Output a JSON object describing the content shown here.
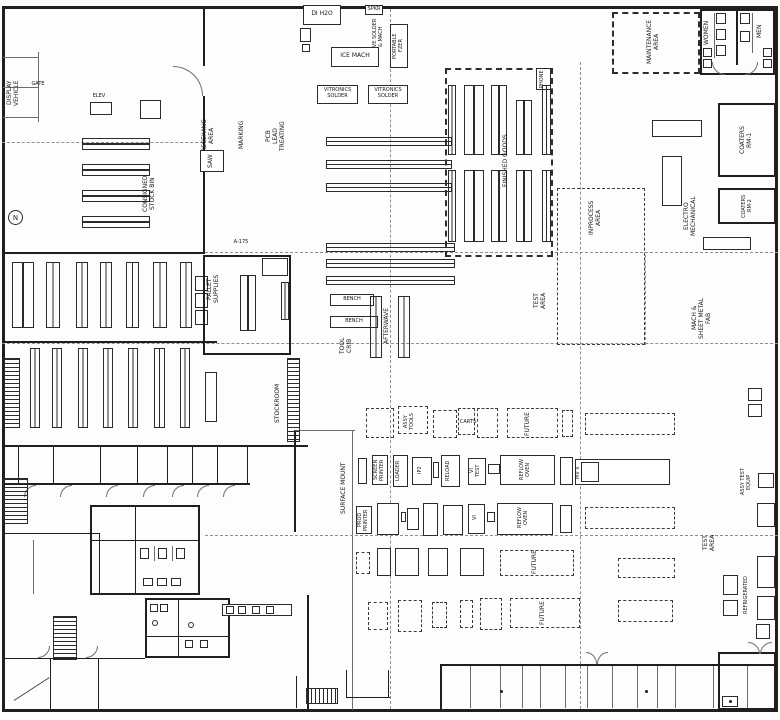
{
  "colors": {
    "paper": "#fdfdfb",
    "ink": "#1f1f1f",
    "grid_gray": "#8f8f8f"
  },
  "labels": {
    "display_vehicle": "DISPLAY\nVEHICLE",
    "gate": "GATE",
    "elev": "ELEV",
    "north_marker": "N",
    "consigned_stock": "CONSIGNED\nSTOCK BIN",
    "receiving_area": "RECEIVING\nAREA",
    "marking": "MARKING",
    "pcb_lead_treating": "PCB\nLEAD\nTREATING",
    "saw": "SAW",
    "a175": "A-175",
    "di_h2o": "DI H2O",
    "spkr": "SPKR",
    "wave_solder": "WAVE SOLDER\n& MACH",
    "portable_fzer": "PORTABLE\nFZER",
    "ice_mach": "ICE MACH",
    "vitronics_1": "VITRONICS\nSOLDER",
    "vitronics_2": "VITRONICS\nSOLDER",
    "bench_1": "BENCH",
    "bench_2": "BENCH",
    "afterwave": "AFTERWAVE",
    "tool_crib": "TOOL\nCRIB",
    "finished_goods": "FINISHED GOODS",
    "phone": "PHONE",
    "inprocess_area": "INPROCESS\nAREA",
    "maintenance_area": "MAINTENANCE\nAREA",
    "women": "WOMEN",
    "men": "MEN",
    "coaters_rm1": "COATERS\nRM-1",
    "coaters_rm2": "COATERS\nRM-2",
    "electro_mechanical": "ELECTRO\nMECHANICAL",
    "sheet_metal_fab": "MACH &\nSHEET METAL\nFAB",
    "test_area_mid": "TEST\nAREA",
    "test_area_right": "TEST\nAREA",
    "stockroom": "STOCKROOM",
    "pallet_supplies": "PALLET\nSUPPLIES",
    "surface_mount": "SURFACE MOUNT",
    "carts": "CARTS",
    "assy_tools": "ASSY\nTOOLS",
    "future_1": "FUTURE",
    "future_2": "FUTURE",
    "future_3": "FUTURE",
    "screen_printer": "SCREEN\nPRINTER",
    "loader": "LOADER",
    "ip2": "IP2",
    "reload": "RELOAD",
    "vi_test": "VI\nTEST",
    "reflow_oven_1": "REFLOW\nOVEN",
    "prod_printer": "PROD\nPRINTER",
    "vi_2": "VI",
    "reflow_oven_2": "REFLOW\nOVEN",
    "mv_ii": "MV II",
    "assy_test_equip": "ASSY TEST\nEQUIP",
    "refrigerated": "REFRIGERATED"
  }
}
